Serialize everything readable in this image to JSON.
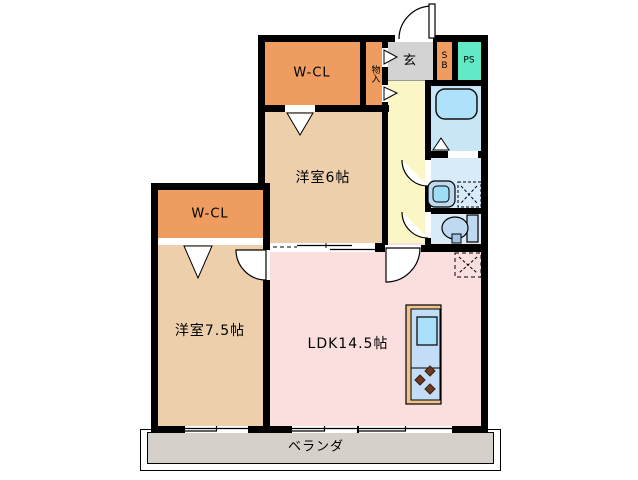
{
  "rooms": {
    "wcl_top": {
      "label": "W-CL"
    },
    "monoire": {
      "label": "物入"
    },
    "genkan": {
      "label": "玄"
    },
    "shoebox": {
      "label": "SB"
    },
    "pipe_space": {
      "label": "PS"
    },
    "bedroom6": {
      "label": "洋室6帖"
    },
    "wcl_lower": {
      "label": "W-CL"
    },
    "bedroom75": {
      "label": "洋室7.5帖"
    },
    "ldk": {
      "label": "LDK14.5帖"
    },
    "veranda": {
      "label": "ベランダ"
    }
  },
  "colors": {
    "wall": "#000000",
    "closet_orange": "#EE9C60",
    "bedroom_tan": "#EDCFAC",
    "ldk_pink": "#FBDEDE",
    "hall_yellow": "#FAF6C6",
    "genkan_gray": "#D3D3D3",
    "pipe_space_teal": "#62E9C5",
    "bath_floor_blue": "#C9E6F7",
    "sanitary_floor_blue": "#D7EBF8",
    "bathtub_blue": "#ADE2FA",
    "fixture_blue": "#BFD9F0",
    "counter_frame_orange": "#F0C28E",
    "counter_top_blue": "#C2DDF5",
    "kitchen_sink_blue": "#A9DFF9",
    "burner_brown": "#6B3A20",
    "veranda_gray": "#D6D0CA"
  }
}
